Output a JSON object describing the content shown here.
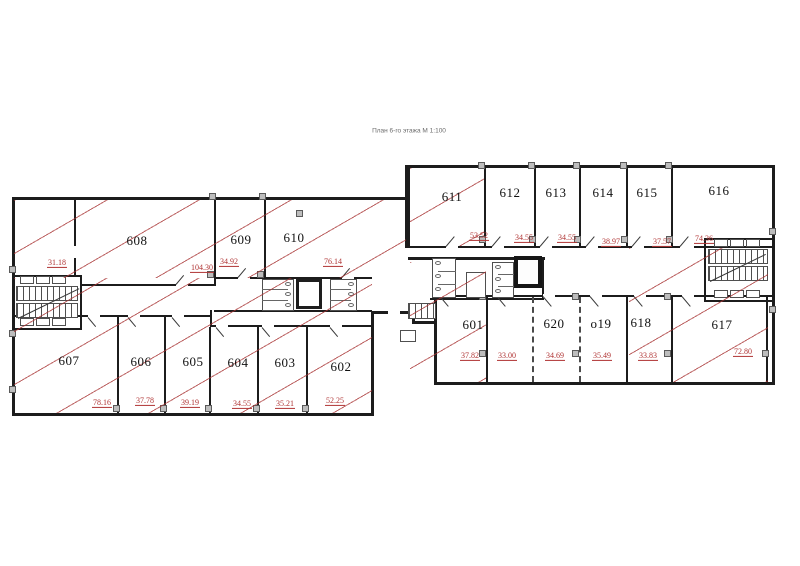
{
  "title": "План 6-го этажа М 1:100",
  "colors": {
    "hatch": "#a83232",
    "area_text": "#b03434",
    "wall": "#1c1c1c",
    "column_fill": "#bdbdbd"
  },
  "rooms": [
    {
      "id": "room-a",
      "label": "",
      "area": "31.18"
    },
    {
      "id": "608",
      "label": "608",
      "area": "104.30"
    },
    {
      "id": "609",
      "label": "609",
      "area": "34.92"
    },
    {
      "id": "610",
      "label": "610",
      "area": "76.14"
    },
    {
      "id": "611",
      "label": "611",
      "area": "53.52"
    },
    {
      "id": "612",
      "label": "612",
      "area": "34.55"
    },
    {
      "id": "613",
      "label": "613",
      "area": "34.55"
    },
    {
      "id": "614",
      "label": "614",
      "area": "38.97"
    },
    {
      "id": "615",
      "label": "615",
      "area": "37.57"
    },
    {
      "id": "616",
      "label": "616",
      "area": "74.36"
    },
    {
      "id": "607",
      "label": "607",
      "area": "78.16"
    },
    {
      "id": "606",
      "label": "606",
      "area": "37.78"
    },
    {
      "id": "605",
      "label": "605",
      "area": "39.19"
    },
    {
      "id": "604",
      "label": "604",
      "area": "34.55"
    },
    {
      "id": "603",
      "label": "603",
      "area": "35.21"
    },
    {
      "id": "602",
      "label": "602",
      "area": "52.25"
    },
    {
      "id": "601",
      "label": "601",
      "area": "37.82"
    },
    {
      "id": "room-b",
      "label": "",
      "area": "33.00"
    },
    {
      "id": "620",
      "label": "620",
      "area": "34.69"
    },
    {
      "id": "619",
      "label": "o19",
      "area": "35.49"
    },
    {
      "id": "618",
      "label": "618",
      "area": "33.83"
    },
    {
      "id": "617",
      "label": "617",
      "area": "72.80"
    }
  ]
}
